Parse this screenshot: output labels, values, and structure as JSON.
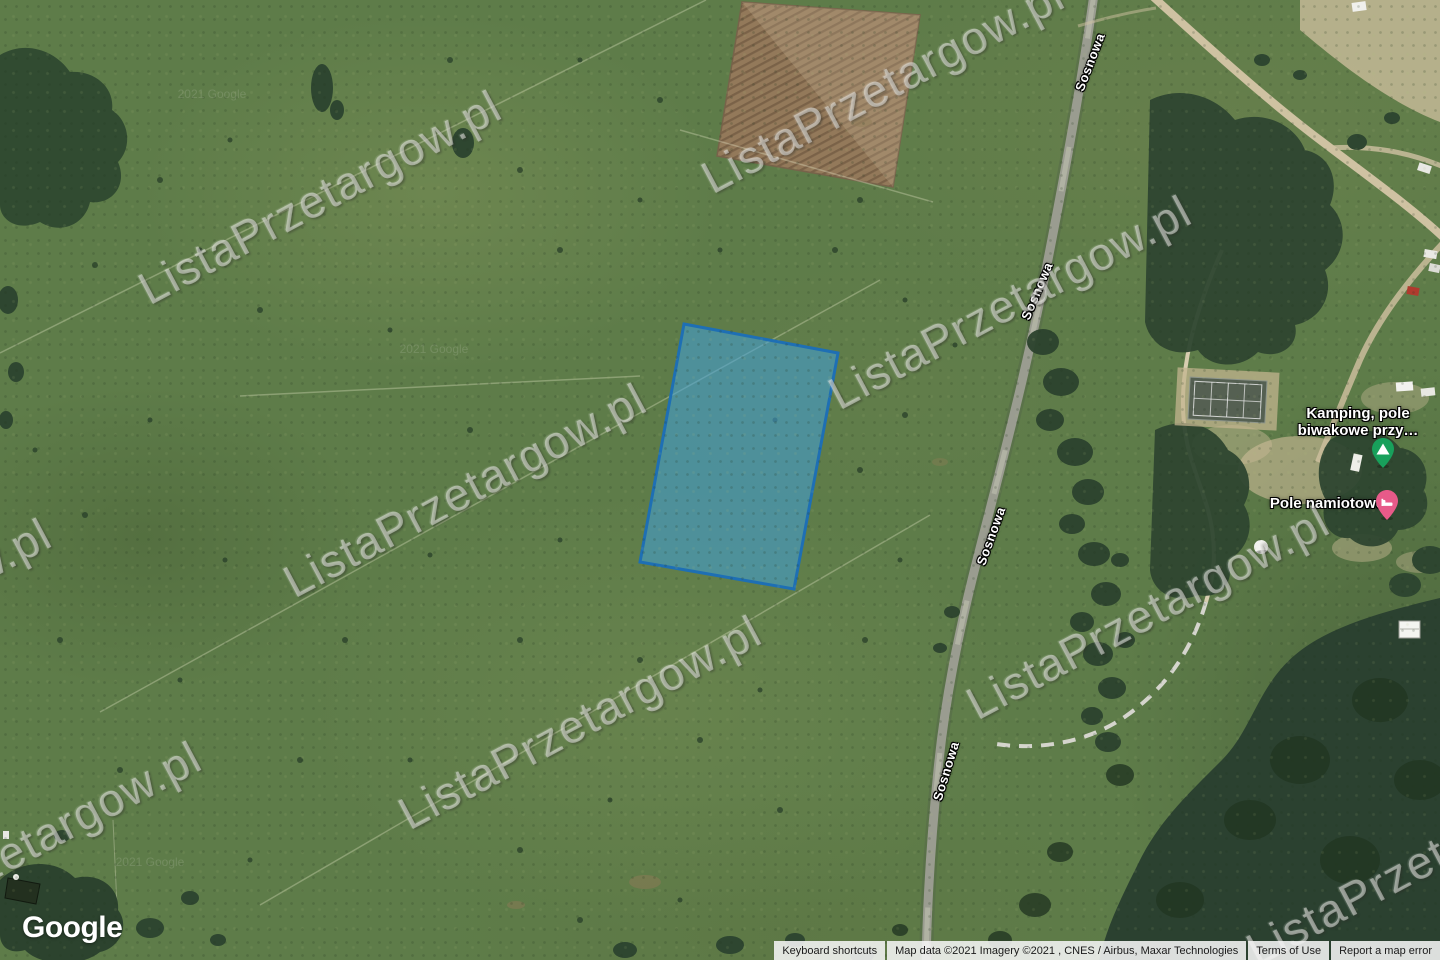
{
  "watermark": {
    "text": "ListaPrzetargow.pl"
  },
  "tile_watermark": {
    "text": "2021 Google"
  },
  "roads": {
    "sosnowa": "Sosnowa"
  },
  "parcel": {
    "fill": "#3FA0DC",
    "stroke": "#1E6FB4"
  },
  "pois": {
    "camping": {
      "line1": "Kamping, pole",
      "line2": "biwakowe przy…",
      "pin_color": "#18A05B"
    },
    "tent_field": {
      "label": "Pole namiotowe",
      "pin_color": "#E75A89"
    }
  },
  "branding": {
    "google_logo": "Google"
  },
  "footer": {
    "keyboard_shortcuts": "Keyboard shortcuts",
    "attribution": "Map data ©2021 Imagery ©2021 , CNES / Airbus, Maxar Technologies",
    "terms": "Terms of Use",
    "report_error": "Report a map error"
  }
}
